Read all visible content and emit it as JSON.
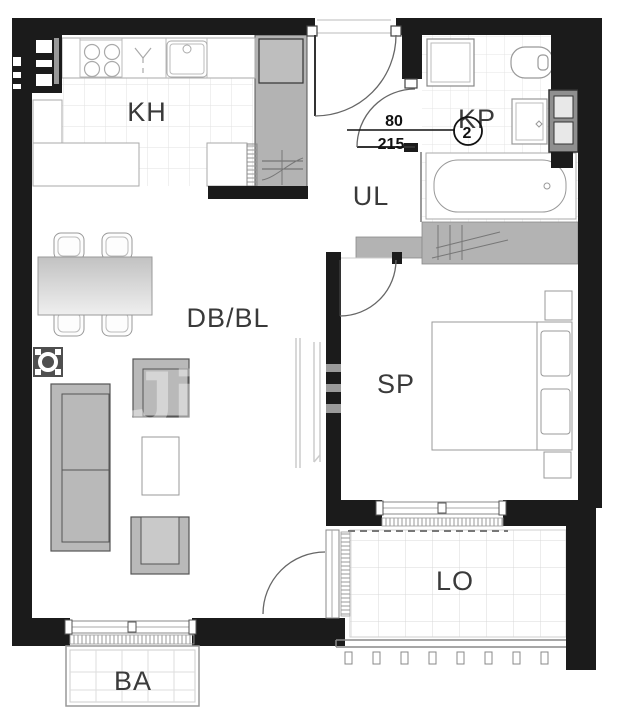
{
  "rooms": {
    "kitchen": {
      "label": "KH"
    },
    "hallway": {
      "label": "UL"
    },
    "bathroom": {
      "label": "KP"
    },
    "living_dining": {
      "label": "DB/BL"
    },
    "bedroom": {
      "label": "SP"
    },
    "loggia": {
      "label": "LO"
    },
    "balcony": {
      "label": "BA"
    }
  },
  "door_annotation": {
    "width_cm": "80",
    "height_cm": "215",
    "door_number": "2"
  },
  "watermark": {
    "text": "Ji"
  },
  "colors": {
    "wall": "#1b1b1b",
    "furniture_fill": "#b9b9b9",
    "shaft_fill": "#b3b3b3",
    "tile_line": "#e2e2e2",
    "label_text": "#3a3a3a",
    "dimension_text": "#111111"
  }
}
